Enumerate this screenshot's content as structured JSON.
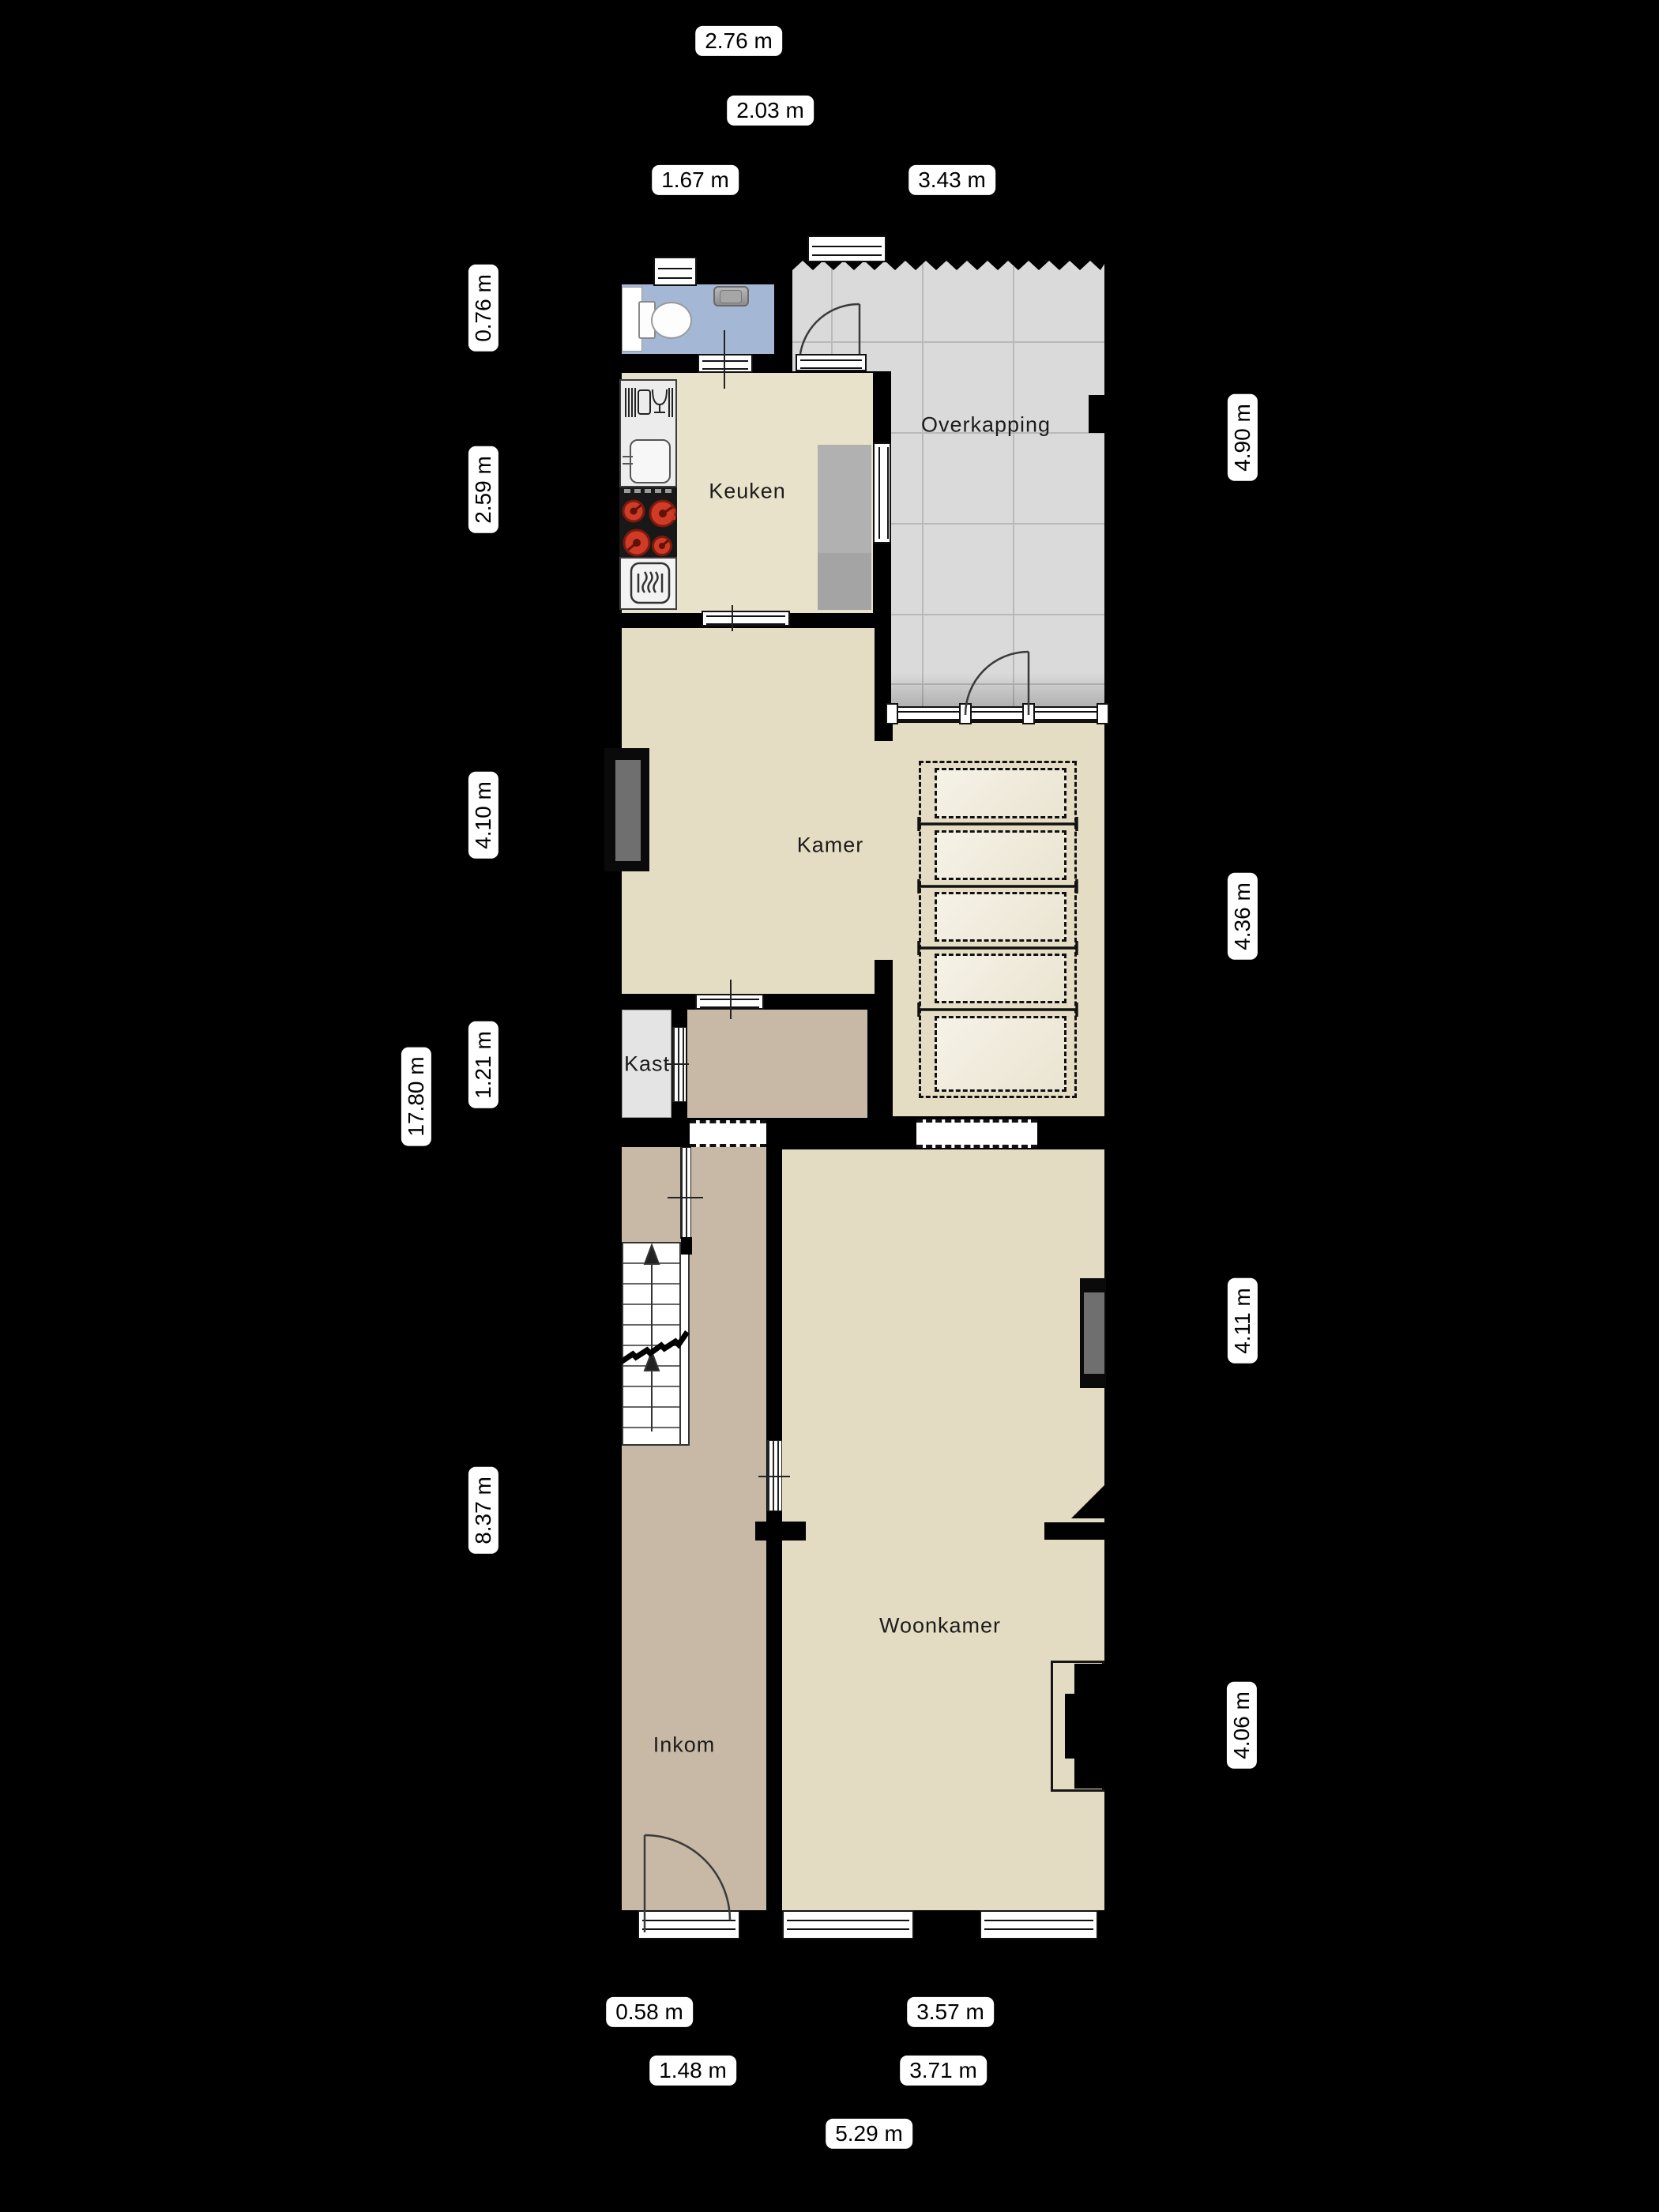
{
  "plan_title": "Floor plan ground floor (Dutch labels)",
  "rooms": {
    "keuken": "Keuken",
    "overkapping": "Overkapping",
    "kamer": "Kamer",
    "kast": "Kast",
    "inkom": "Inkom",
    "woonkamer": "Woonkamer"
  },
  "dims": {
    "top": [
      "2.76 m",
      "2.03 m",
      "1.67 m",
      "3.43 m"
    ],
    "left": [
      "0.76 m",
      "2.59 m",
      "4.10 m",
      "1.21 m",
      "17.80 m",
      "8.37 m"
    ],
    "right": [
      "4.90 m",
      "4.36 m",
      "4.11 m",
      "4.06 m"
    ],
    "bottom": [
      "0.58 m",
      "3.57 m",
      "1.48 m",
      "3.71 m",
      "5.29 m"
    ]
  },
  "colors": {
    "background": "#000000",
    "wall": "#000000",
    "floor_beige": "#e5ddc3",
    "floor_kitchen": "#e9e2cb",
    "floor_hall_tan": "#c7b9a5",
    "floor_kast_gray": "#e4e4e4",
    "floor_toilet_blue": "#a4b8d6",
    "floor_overkapping_gray": "#dadada",
    "counter_gray": "#b1b1b1",
    "burner_red": "#d03b27",
    "window_pane_gray": "#6f6f6f",
    "label_bg": "#ffffff",
    "label_text": "#000000"
  },
  "icons": [
    "toilet-icon",
    "washbasin-icon",
    "dishwasher-icon",
    "kitchen-sink-icon",
    "cooktop-icon",
    "oven-icon",
    "door-swing-icon",
    "window-icon",
    "stairs-icon",
    "up-arrow-icon"
  ]
}
